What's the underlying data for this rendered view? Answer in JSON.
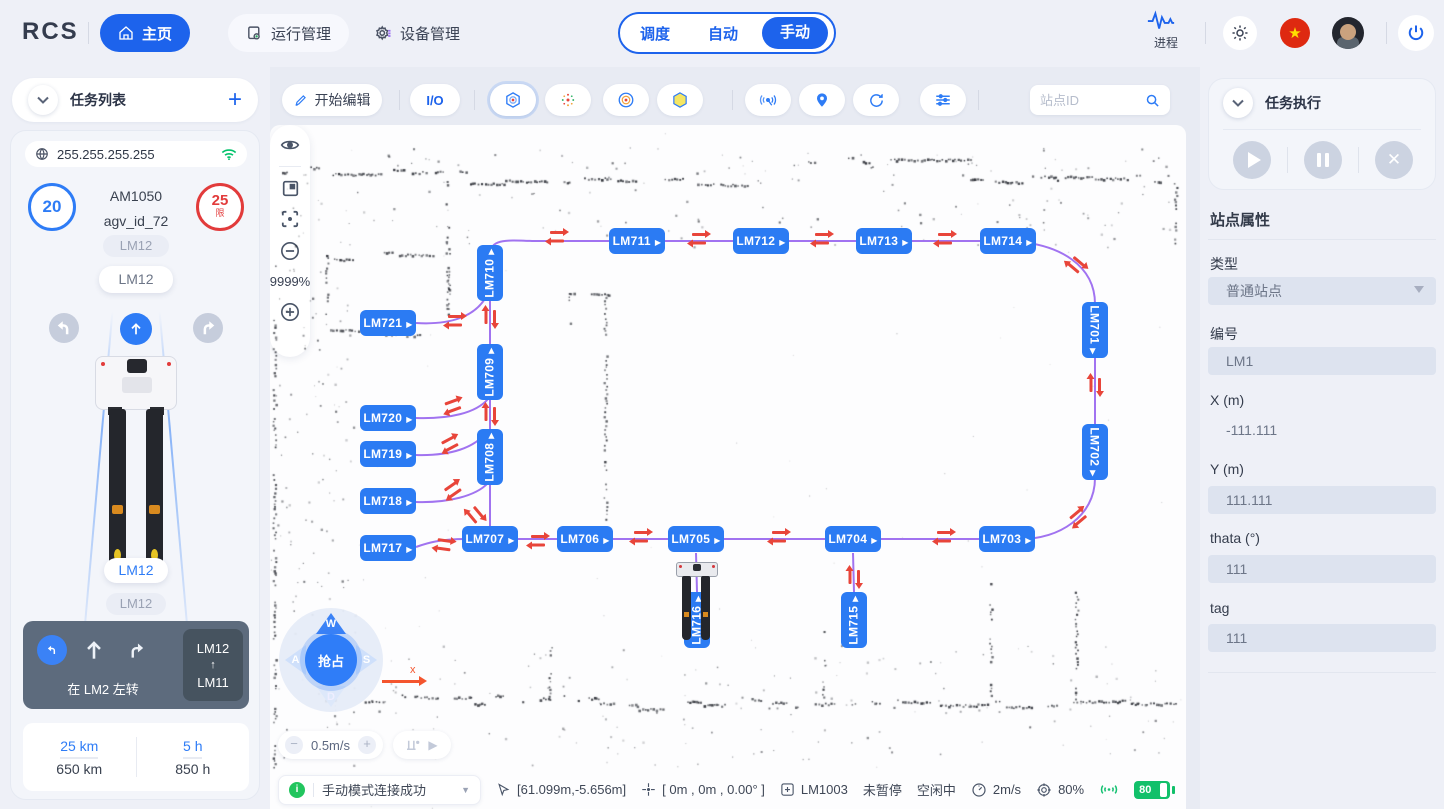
{
  "navbar": {
    "logo": "RCS",
    "items": [
      {
        "label": "主页",
        "icon": "home-icon",
        "active": true
      },
      {
        "label": "运行管理",
        "icon": "monitor-icon",
        "active": false
      },
      {
        "label": "设备管理",
        "icon": "gear-icon",
        "active": false
      }
    ],
    "process_label": "进程"
  },
  "tabs": {
    "items": [
      "调度",
      "自动",
      "手动"
    ],
    "active": "手动"
  },
  "left": {
    "title": "任务列表",
    "ip": "255.255.255.255",
    "speed_value": "20",
    "limit_value": "25",
    "limit_suffix": "限",
    "model": "AM1050",
    "agv_id": "agv_id_72",
    "station_tags": [
      "LM12",
      "LM12",
      "LM12",
      "LM12"
    ],
    "nav_card": {
      "action": "在 LM2 左转",
      "from": "LM12",
      "arrow": "↑",
      "to": "LM11"
    },
    "stats": [
      {
        "top": "25 km",
        "bottom": "650 km"
      },
      {
        "top": "5 h",
        "bottom": "850 h"
      }
    ]
  },
  "toolbar": {
    "edit_label": "开始编辑",
    "io_label": "I/O",
    "search_placeholder": "站点ID",
    "icon_buttons": [
      {
        "icon": "hexagon-target-icon",
        "x": 220,
        "selected": true
      },
      {
        "icon": "scatter-points-icon",
        "x": 275,
        "selected": false
      },
      {
        "icon": "circle-target-icon",
        "x": 333,
        "selected": false
      },
      {
        "icon": "hexagon-yellow-icon",
        "x": 387,
        "selected": false
      },
      {
        "icon": "radar-icon",
        "x": 475,
        "selected": false
      },
      {
        "icon": "location-pin-icon",
        "x": 529,
        "selected": false
      },
      {
        "icon": "refresh-icon",
        "x": 583,
        "selected": false
      },
      {
        "icon": "sliders-icon",
        "x": 650,
        "selected": false
      }
    ]
  },
  "map": {
    "stations": [
      {
        "label": "LM711",
        "x": 367,
        "y": 116,
        "o": "h"
      },
      {
        "label": "LM712",
        "x": 491,
        "y": 116,
        "o": "h"
      },
      {
        "label": "LM713",
        "x": 614,
        "y": 116,
        "o": "h"
      },
      {
        "label": "LM714",
        "x": 738,
        "y": 116,
        "o": "h"
      },
      {
        "label": "LM710",
        "x": 220,
        "y": 148,
        "o": "vu"
      },
      {
        "label": "LM721",
        "x": 118,
        "y": 198,
        "o": "h"
      },
      {
        "label": "LM709",
        "x": 220,
        "y": 247,
        "o": "vu"
      },
      {
        "label": "LM720",
        "x": 118,
        "y": 293,
        "o": "h"
      },
      {
        "label": "LM719",
        "x": 118,
        "y": 329,
        "o": "h"
      },
      {
        "label": "LM708",
        "x": 220,
        "y": 332,
        "o": "vu"
      },
      {
        "label": "LM718",
        "x": 118,
        "y": 376,
        "o": "h"
      },
      {
        "label": "LM717",
        "x": 118,
        "y": 423,
        "o": "h"
      },
      {
        "label": "LM707",
        "x": 220,
        "y": 414,
        "o": "h"
      },
      {
        "label": "LM706",
        "x": 315,
        "y": 414,
        "o": "h"
      },
      {
        "label": "LM705",
        "x": 426,
        "y": 414,
        "o": "h"
      },
      {
        "label": "LM704",
        "x": 583,
        "y": 414,
        "o": "h"
      },
      {
        "label": "LM703",
        "x": 737,
        "y": 414,
        "o": "h"
      },
      {
        "label": "LM701",
        "x": 825,
        "y": 205,
        "o": "vd"
      },
      {
        "label": "LM702",
        "x": 825,
        "y": 327,
        "o": "vd"
      },
      {
        "label": "LM716",
        "x": 427,
        "y": 495,
        "o": "vu"
      },
      {
        "label": "LM715",
        "x": 584,
        "y": 495,
        "o": "vu"
      }
    ],
    "arrow_pairs": [
      [
        287,
        112,
        0
      ],
      [
        429,
        114,
        0
      ],
      [
        552,
        114,
        0
      ],
      [
        675,
        114,
        0
      ],
      [
        806,
        140,
        40
      ],
      [
        825,
        260,
        90
      ],
      [
        808,
        392,
        140
      ],
      [
        674,
        412,
        0
      ],
      [
        509,
        412,
        0
      ],
      [
        371,
        412,
        0
      ],
      [
        268,
        416,
        0
      ],
      [
        174,
        420,
        8
      ],
      [
        185,
        196,
        0
      ],
      [
        220,
        192,
        90
      ],
      [
        220,
        289,
        90
      ],
      [
        183,
        281,
        -20
      ],
      [
        180,
        319,
        -28
      ],
      [
        183,
        365,
        -35
      ],
      [
        205,
        390,
        50
      ],
      [
        584,
        452,
        90
      ]
    ],
    "zoom_percent": "9999%",
    "joystick": {
      "center_label": "抢占",
      "keys": [
        "W",
        "A",
        "S",
        "D"
      ]
    },
    "speed_label": "0.5m/s",
    "axis_label": "x"
  },
  "right": {
    "title": "任务执行",
    "props_title": "站点属性",
    "fields": [
      {
        "label": "类型",
        "value": "普通站点",
        "kind": "select",
        "ly": 187,
        "vy": 210
      },
      {
        "label": "编号",
        "value": "LM1",
        "kind": "input",
        "ly": 257,
        "vy": 280
      },
      {
        "label": "X (m)",
        "value": "-111.111",
        "kind": "text",
        "ly": 325,
        "vy": 351
      },
      {
        "label": "Y (m)",
        "value": "111.111",
        "kind": "input",
        "ly": 394,
        "vy": 419
      },
      {
        "label": "thata (°)",
        "value": "111",
        "kind": "input",
        "ly": 463,
        "vy": 488
      },
      {
        "label": "tag",
        "value": "111",
        "kind": "input",
        "ly": 533,
        "vy": 557
      }
    ]
  },
  "status": {
    "mode_text": "手动模式连接成功",
    "items": [
      {
        "icon": "cursor-icon",
        "text": "[61.099m,-5.656m]"
      },
      {
        "icon": "crosshair-icon",
        "text": "[ 0m , 0m , 0.00° ]"
      },
      {
        "icon": "plus-square-icon",
        "text": "LM1003"
      },
      {
        "icon": "",
        "text": "未暂停"
      },
      {
        "icon": "",
        "text": "空闲中"
      },
      {
        "icon": "speedometer-icon",
        "text": "2m/s"
      },
      {
        "icon": "position-target-icon",
        "text": "80%"
      },
      {
        "icon": "signal-icon",
        "text": ""
      },
      {
        "icon": "battery-icon",
        "text": "80"
      }
    ]
  }
}
